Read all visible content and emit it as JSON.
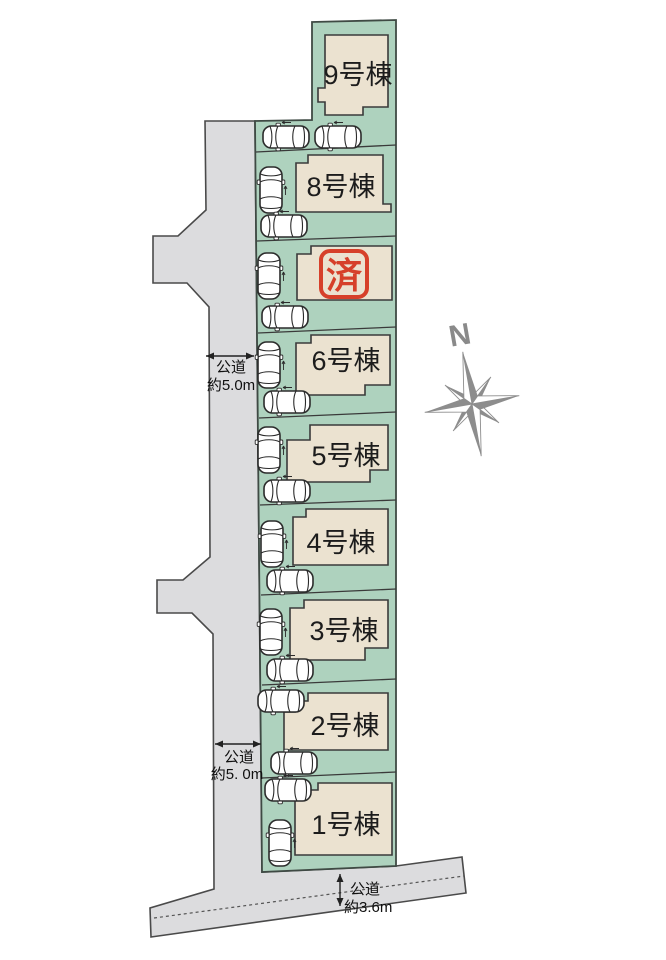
{
  "plan": {
    "lots": [
      {
        "name": "lot-9",
        "label": "9号棟"
      },
      {
        "name": "lot-8",
        "label": "8号棟"
      },
      {
        "name": "lot-7",
        "label": "",
        "sold": true
      },
      {
        "name": "lot-6",
        "label": "6号棟"
      },
      {
        "name": "lot-5",
        "label": "5号棟"
      },
      {
        "name": "lot-4",
        "label": "4号棟"
      },
      {
        "name": "lot-3",
        "label": "3号棟"
      },
      {
        "name": "lot-2",
        "label": "2号棟"
      },
      {
        "name": "lot-1",
        "label": "1号棟"
      }
    ],
    "sold_stamp": {
      "text": "済",
      "color": "#d6402a"
    },
    "compass": {
      "north_label": "N"
    },
    "road_annotations": [
      {
        "line1": "公道",
        "line2": "約5.0m"
      },
      {
        "line1": "公道",
        "line2": "約5. 0m"
      },
      {
        "line1": "公道",
        "line2": "約3.6m"
      }
    ],
    "colors": {
      "lot_green": "#aed2be",
      "house_beige": "#ebe2d0",
      "road_gray": "#dcdcde",
      "outline": "#3a3a3a",
      "stamp_red": "#d6402a",
      "compass_gray": "#8d8d8d"
    }
  }
}
